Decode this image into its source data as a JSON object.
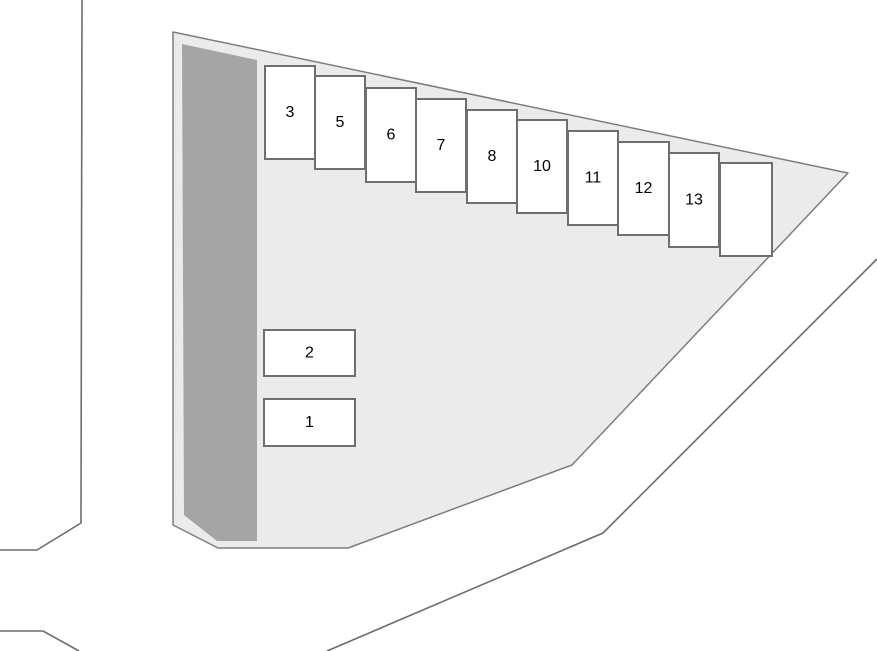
{
  "scene": {
    "width": 877,
    "height": 651,
    "background": "#ffffff",
    "description": "Parking lot site plan with numbered stalls"
  },
  "colors": {
    "lot_fill": "#ebebeb",
    "lot_stroke": "#7d7d7d",
    "building_fill": "#a5a5a5",
    "stall_fill": "#ffffff",
    "stall_stroke": "#6e6e6e",
    "road_stroke": "#6b6b6b",
    "label_color": "#000000"
  },
  "label_font_size": 16,
  "lot": {
    "outline": [
      [
        173,
        32
      ],
      [
        848,
        173
      ],
      [
        572,
        465
      ],
      [
        348,
        548
      ],
      [
        218,
        548
      ],
      [
        173,
        525
      ]
    ]
  },
  "building": {
    "outline": [
      [
        182,
        44
      ],
      [
        257,
        60
      ],
      [
        257,
        541
      ],
      [
        217,
        541
      ],
      [
        184,
        515
      ]
    ]
  },
  "roads": [
    {
      "name": "left-road-edge",
      "points": [
        [
          82,
          0
        ],
        [
          81,
          523
        ],
        [
          37,
          550
        ],
        [
          0,
          550
        ]
      ]
    },
    {
      "name": "bottom-left-road-edge",
      "points": [
        [
          0,
          631
        ],
        [
          43,
          631
        ],
        [
          79,
          651
        ]
      ]
    },
    {
      "name": "right-road-edge",
      "points": [
        [
          877,
          259
        ],
        [
          603,
          533
        ],
        [
          327,
          651
        ]
      ]
    }
  ],
  "stalls": [
    {
      "label": "3",
      "x": 265,
      "y": 66,
      "w": 50,
      "h": 93
    },
    {
      "label": "5",
      "x": 315,
      "y": 76,
      "w": 50,
      "h": 93
    },
    {
      "label": "6",
      "x": 366,
      "y": 88,
      "w": 50,
      "h": 94
    },
    {
      "label": "7",
      "x": 416,
      "y": 99,
      "w": 50,
      "h": 93
    },
    {
      "label": "8",
      "x": 467,
      "y": 110,
      "w": 50,
      "h": 93
    },
    {
      "label": "10",
      "x": 517,
      "y": 120,
      "w": 50,
      "h": 93
    },
    {
      "label": "11",
      "x": 568,
      "y": 131,
      "w": 50,
      "h": 94
    },
    {
      "label": "12",
      "x": 618,
      "y": 142,
      "w": 51,
      "h": 93
    },
    {
      "label": "13",
      "x": 669,
      "y": 153,
      "w": 50,
      "h": 94
    },
    {
      "label": "",
      "x": 720,
      "y": 163,
      "w": 52,
      "h": 93
    },
    {
      "label": "2",
      "x": 264,
      "y": 330,
      "w": 91,
      "h": 46
    },
    {
      "label": "1",
      "x": 264,
      "y": 399,
      "w": 91,
      "h": 47
    }
  ]
}
